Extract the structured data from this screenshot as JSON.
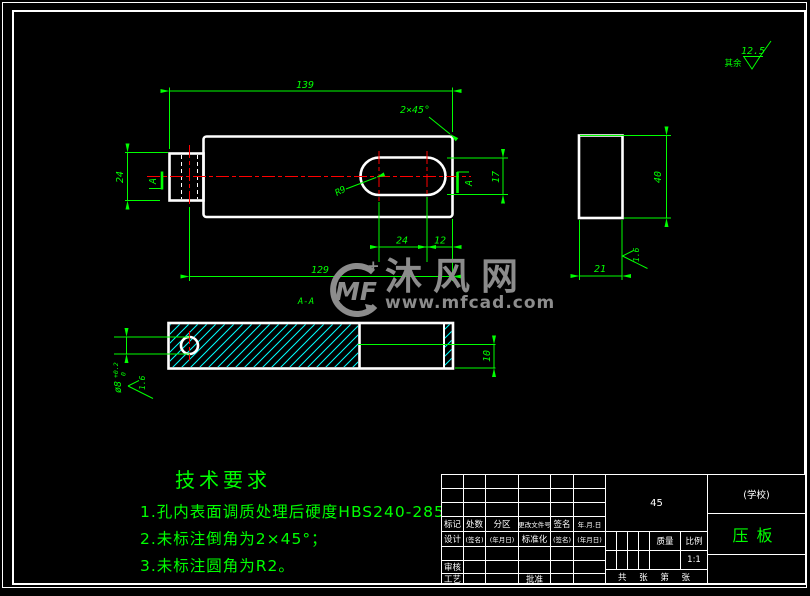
{
  "colors": {
    "background": "#000000",
    "outline": "#ffffff",
    "dimension": "#00ff00",
    "centerline": "#ff0000",
    "hatch": "#00ffff",
    "watermark": "#8c8c8c"
  },
  "dimensions": {
    "top_length": "139",
    "tab_width": "24",
    "slot_height": "17",
    "slot_len": "24",
    "slot_end": "12",
    "overall": "129",
    "side_height": "40",
    "side_width": "21",
    "step": "10",
    "hole_dia": "ø8",
    "hole_tol_up": "+0.2",
    "hole_tol_dn": "0"
  },
  "annotations": {
    "chamfer": "2×45°",
    "slot_radius": "R9",
    "section_label": "A-A",
    "section_mark_left": "A",
    "section_mark_right": "A"
  },
  "surface": {
    "rest": "其余",
    "value": "12.5",
    "fine_side": "1.6",
    "fine_hole": "1.6"
  },
  "tech_requirements": {
    "title": "技术要求",
    "item1": "1.孔内表面调质处理后硬度HBS240-285;",
    "item2": "2.未标注倒角为2×45°；",
    "item3": "3.未标注圆角为R2。"
  },
  "watermark": {
    "logo": "MF",
    "name": "沐风网",
    "url": "www.mfcad.com"
  },
  "title_block": {
    "c1": "标记",
    "c2": "处数",
    "c3": "分区",
    "c4": "更改文件号",
    "c5": "签名",
    "c6": "年.月.日",
    "d1": "设计",
    "d2": "(签名)",
    "d3": "(年月日)",
    "d4": "标准化",
    "d5": "(签名)",
    "d6": "(年月日)",
    "shenhe": "审核",
    "gongyi": "工艺",
    "pizhun": "批准",
    "material": "45",
    "mass": "质量",
    "scale_label": "比例",
    "scale": "1:1",
    "sheets": "共 张 第 张",
    "school": "(学校)",
    "part": "压板"
  }
}
